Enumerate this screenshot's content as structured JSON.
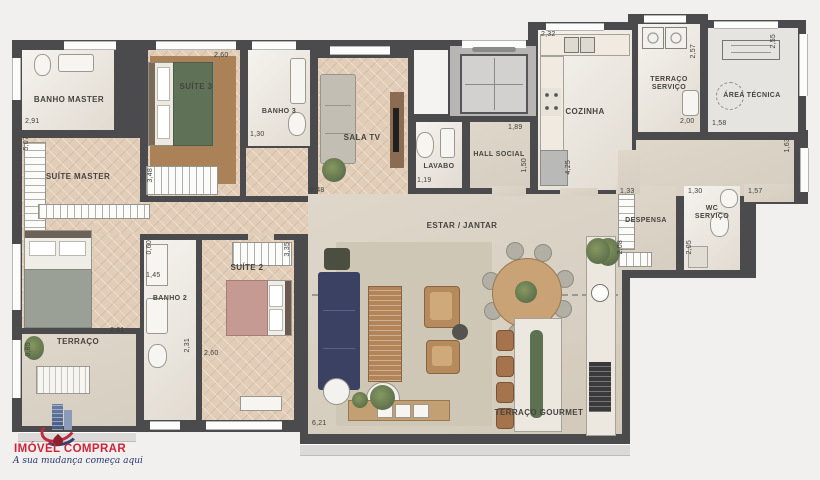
{
  "plan": {
    "rooms": {
      "banho_master": {
        "label": "BANHO MASTER"
      },
      "suite_master": {
        "label": "SUÍTE MASTER"
      },
      "suite_3": {
        "label": "SUÍTE 3"
      },
      "banho_3": {
        "label": "BANHO 3"
      },
      "sala_tv": {
        "label": "SALA TV"
      },
      "lavabo": {
        "label": "LAVABO"
      },
      "hall_social": {
        "label": "HALL SOCIAL"
      },
      "cozinha": {
        "label": "COZINHA"
      },
      "terraco_servico": {
        "label": "TERRAÇO SERVIÇO"
      },
      "area_tecnica": {
        "label": "ÁREA TÉCNICA"
      },
      "despensa": {
        "label": "DESPENSA"
      },
      "wc_servico": {
        "label": "WC SERVIÇO"
      },
      "estar_jantar": {
        "label": "ESTAR / JANTAR"
      },
      "suite_2": {
        "label": "SUÍTE 2"
      },
      "banho_2": {
        "label": "BANHO 2"
      },
      "terraco": {
        "label": "TERRAÇO"
      },
      "terraco_gourmet": {
        "label": "TERRAÇO GOURMET"
      }
    },
    "dims": {
      "banho_master_w": "2,91",
      "suite_master_h": "5,07",
      "suite3_w": "2,60",
      "suite3_wardrobe": "3,48",
      "banho3_w": "1,30",
      "estar_w": "8,48",
      "lavabo_w": "1,19",
      "hall_w": "1,89",
      "hall_h": "1,50",
      "cozinha_w": "2,32",
      "cozinha_h": "4,25",
      "tservico_h": "2,57",
      "tservico_w": "2,00",
      "atecnica_h": "2,55",
      "atecnica_w": "1,58",
      "corr_right_h": "1,63",
      "despensa_w": "1,33",
      "wc_w": "1,30",
      "corr_right_w": "1,57",
      "despensa_h": "2,08",
      "wc_h": "2,05",
      "banho2_niche": "0,60",
      "banho2_w": "1,45",
      "banho2_h": "2,31",
      "suite2_h": "3,35",
      "suite2_w": "2,60",
      "terraco_w": "2,61",
      "terraco_h": "0,85",
      "gourmet_w": "6,21"
    },
    "colors": {
      "wall": "#4b4b4d",
      "wood_floor": "#e2ceb8",
      "accent_green": "#5e7350",
      "sofa_navy": "#3a4162"
    }
  },
  "logo": {
    "name": "IMÓVEL COMPRAR",
    "tagline": "A sua mudança começa aqui",
    "brand_red": "#cf2438",
    "brand_navy": "#24356e"
  }
}
